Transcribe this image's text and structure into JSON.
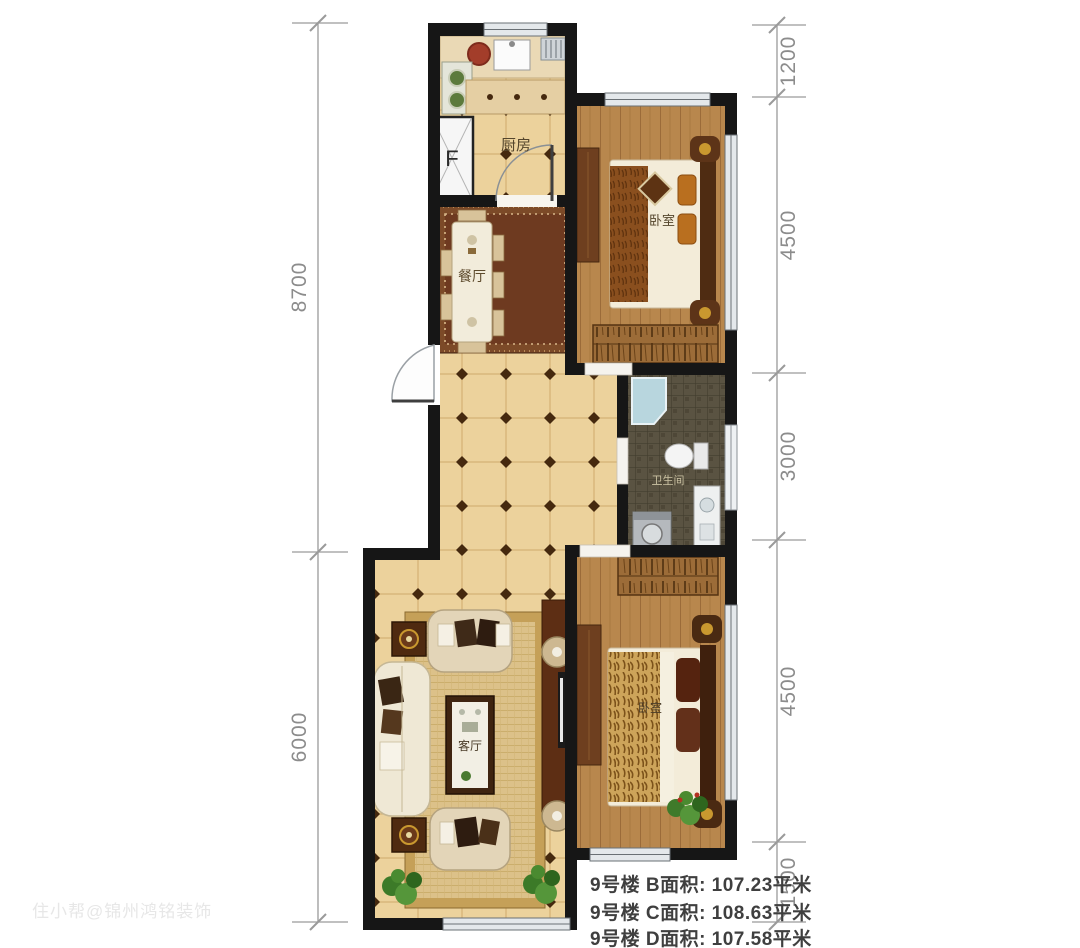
{
  "rooms": {
    "kitchen": {
      "label": "厨房"
    },
    "dining": {
      "label": "餐厅"
    },
    "bedroom_top": {
      "label": "卧室"
    },
    "bathroom": {
      "label": "卫生间"
    },
    "bedroom_bottom": {
      "label": "卧室"
    },
    "living": {
      "label": "客厅"
    }
  },
  "fixtures": {
    "flue_label": "F"
  },
  "dimensions": {
    "left": [
      {
        "value": "8700"
      },
      {
        "value": "6000"
      }
    ],
    "right": [
      {
        "value": "1200"
      },
      {
        "value": "4500"
      },
      {
        "value": "3000"
      },
      {
        "value": "4500"
      },
      {
        "value": "1500"
      }
    ]
  },
  "area_table": {
    "rows": [
      {
        "text": "9号楼 B面积: 107.23平米"
      },
      {
        "text": "9号楼 C面积: 108.63平米"
      },
      {
        "text": "9号楼 D面积: 107.58平米"
      }
    ]
  },
  "watermark": {
    "text": "住小帮@锦州鸿铭装饰"
  },
  "colors": {
    "wall": "#161616",
    "tile_floor": "#ecd29c",
    "wood_floor": "#b8874d",
    "bath_tile": "#5a5342",
    "dining_rug": "#6e3a20",
    "living_rug": "#dcc189",
    "window": "#e4e8eb",
    "dimension": "#8c8c8c",
    "area_text": "#3f3f3f"
  }
}
